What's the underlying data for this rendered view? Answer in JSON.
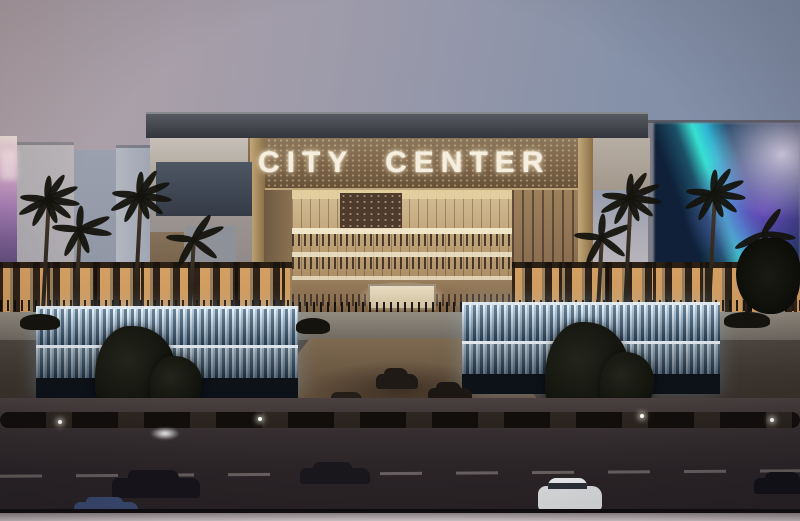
{
  "scene": {
    "type": "architectural rendering photograph",
    "description": "Dusk exterior rendering of the City Center shopping mall: illuminated glass atrium entrance, golden signage band, flanking grey wings with LED billboards, palm trees, cascading illuminated fountains, and a dark foreground road with cars",
    "sign_text": "CITY CENTER",
    "time_of_day": "dusk"
  },
  "colors": {
    "sky_top_left": "#b2a3a8",
    "sky_top_right": "#7e8ba5",
    "sky_horizon": "#e8d5cb",
    "roof": "#34363c",
    "sign_band": "#7c6449",
    "sign_text": "#f6efdf",
    "atrium_glow": "#c2a77b",
    "storefront_light": "#ffbe73",
    "fountain_water": "#dcecf9",
    "billboard_left_pink": "#ab81b7",
    "billboard_right_teal": "#37e2d3",
    "billboard_right_purple": "#704fc8",
    "road": "#2a2427",
    "bottom_strip": "#d2c9cb"
  },
  "objects": {
    "palm_count": 8,
    "fountains": 2,
    "foreground_cars": 5,
    "plaza_cars": 4
  }
}
